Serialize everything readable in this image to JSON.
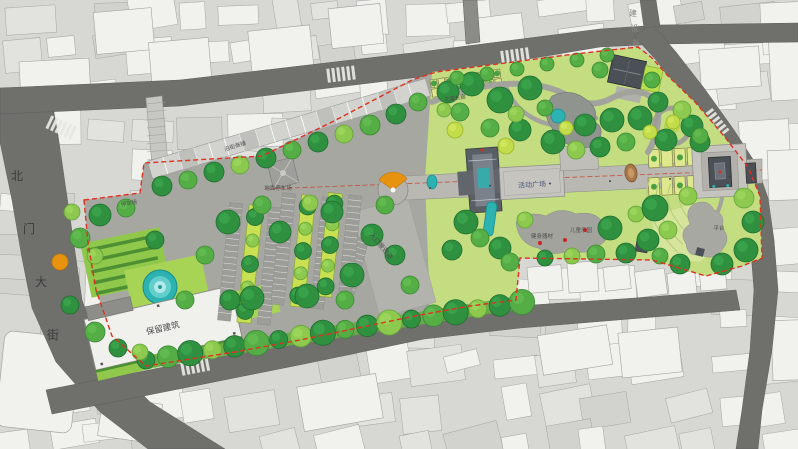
{
  "roads": {
    "left_road_label": "北门大街",
    "top_lane_label": "建设巷"
  },
  "site": {
    "retained_building_label": "保留建筑",
    "entrance_axis_label": "入口景观道",
    "activity_plaza_label": "活动广场",
    "parking_label": "地面停车场",
    "parking_west_label": "停车场",
    "shops_label": "沿街商铺",
    "pergola_label": "花架长廊",
    "fitness_label": "健身器材",
    "children_label": "儿童乐园",
    "platform_label": "平台"
  },
  "palette": {
    "canvas_bg": "#d7d7d4",
    "building_light": "#f1f1ee",
    "building_mid": "#e2e2df",
    "building_dark": "#d2d2cf",
    "building_stroke": "#a3a3a0",
    "road": "#6f6f6c",
    "road_minor": "#8b8b88",
    "site_pavement": "#a7a7a2",
    "axis_pavement": "#bab8b2",
    "plaza_light": "#c6c4be",
    "green_base": "#c3dd80",
    "lawn_light": "#d5e69c",
    "lawn_mid": "#a8d455",
    "lawn_bright": "#8fc84a",
    "tree_dark": "#2f9040",
    "tree_mid": "#55ad45",
    "tree_light": "#8cc94e",
    "tree_yellow": "#c3dc49",
    "hedge": "#4e8f33",
    "water": "#2cb3b1",
    "water_light": "#8fdedd",
    "accent_orange": "#e8930f",
    "boundary_red": "#de3220",
    "axis_red_line": "#c84836",
    "structure_dark": "#4b5056",
    "label_dark": "#3b3b39",
    "label_gray": "#4c4c4a"
  }
}
